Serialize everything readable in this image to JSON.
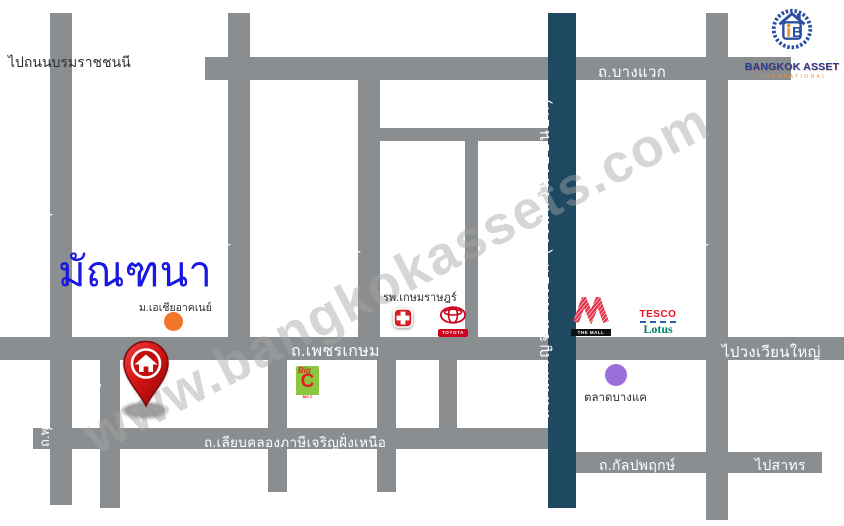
{
  "map": {
    "project": {
      "name": "มัณฑนา"
    },
    "watermark": "www.bangkokassets.com",
    "logo": {
      "name": "BANGKOK ASSET",
      "subtitle": "INTERNATIONAL"
    },
    "directions": {
      "to_borommaratchachonnani": "ไปถนนบรมราชชนนี",
      "to_wongwian_yai": "ไปวงเวียนใหญ่",
      "to_sathorn": "ไปสาทร"
    },
    "roads": {
      "bangwaek": "ถ.บางแวก",
      "phetkasem": "ถ.เพชรเกษม",
      "liap_khlong_phasi_charoen": "ถ.เลียบคลองภาษีเจริญฝั่งเหนือ",
      "kanlapaphruek": "ถ.กัลปพฤกษ์",
      "phutthamonthon_sai4": "ถ.พุทธมณฑลสาย 4",
      "phutthamonthon_sai3": "ถ.พุทธมณฑลสาย 3",
      "phutthamonthon_sai2": "ถ.พุทธมณฑลสาย 2",
      "phutthamonthon_sai1": "ถ.พุทธมณฑลสาย 1",
      "phutthasakhon": "ถ.พุทธสาคร",
      "soi_macharoen_81": "ซ.มาเจริญ 81",
      "kanchanaphisek": "ถนนกาญจนาภิเษก (วงแหวนรอบนอก)"
    },
    "landmarks": {
      "university": "ม.เอเชียอาคเนย์",
      "hospital": "รพ.เกษมราษฎร์",
      "market": "ตลาดบางแค",
      "toyota": "TOYOTA",
      "the_mall": "THE MALL",
      "tesco": "TESCO",
      "lotus": "Lotus",
      "bigc_big": "Big",
      "bigc_c": "C",
      "bigc_strip": "BIG C"
    },
    "colors": {
      "road_gray": "#8a8e91",
      "highway_blue": "#1e4961",
      "project_blue": "#1a17e0",
      "market_purple": "#9c6ed9",
      "university_orange": "#f1762a",
      "pin_red": "#c40f0f"
    }
  }
}
